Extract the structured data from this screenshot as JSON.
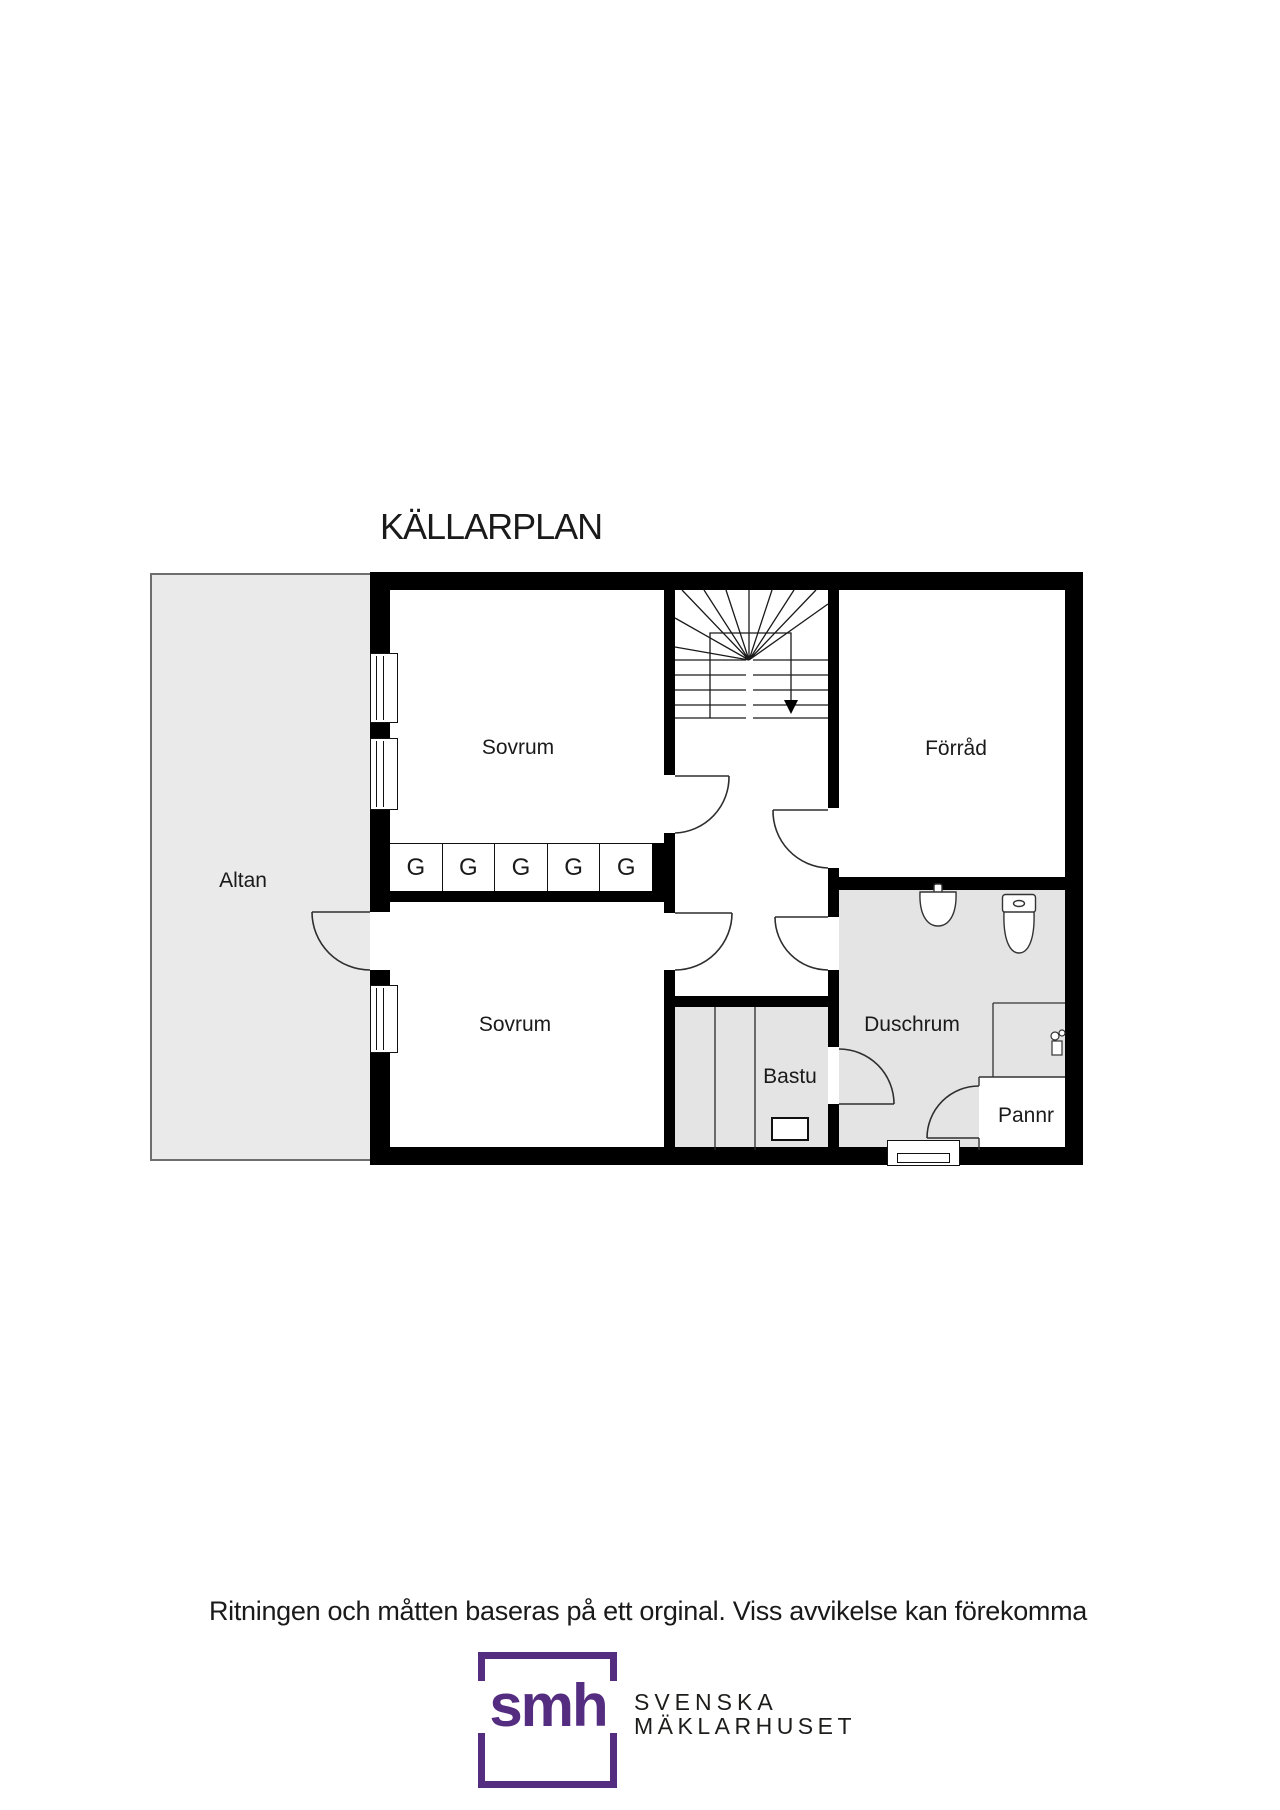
{
  "title": "KÄLLARPLAN",
  "rooms": {
    "altan": "Altan",
    "sovrum_1": "Sovrum",
    "sovrum_2": "Sovrum",
    "forrad": "Förråd",
    "duschrum": "Duschrum",
    "bastu": "Bastu",
    "pannr": "Pannr"
  },
  "wardrobes": [
    "G",
    "G",
    "G",
    "G",
    "G"
  ],
  "disclaimer": "Ritningen och måtten baseras på ett orginal. Viss avvikelse kan förekomma",
  "logo": {
    "monogram": "smh",
    "brand_line1": "SVENSKA",
    "brand_line2": "MÄKLARHUSET"
  },
  "colors": {
    "wall": "#000000",
    "floor_gray": "#e4e4e4",
    "altan_gray": "#eaeaea",
    "brand_purple": "#552d80"
  }
}
